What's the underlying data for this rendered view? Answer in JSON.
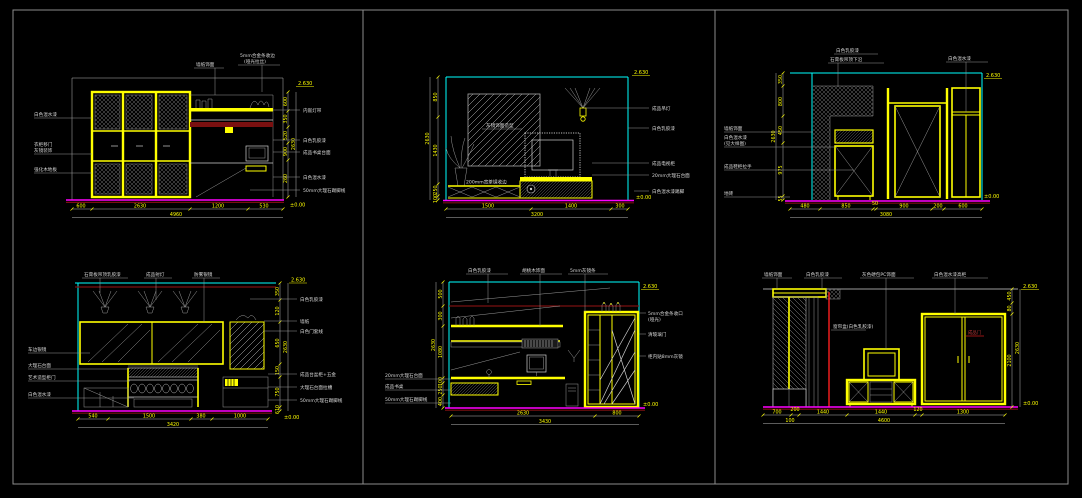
{
  "sheet": {
    "background": "#000000",
    "frame_color": "#8d8d8d",
    "grid": "3 columns x 2 rows of elevation drawings"
  },
  "colors": {
    "accent_yellow": "#ffff00",
    "accent_cyan": "#00ffff",
    "baseline_magenta": "#ff00ff",
    "dark_red": "#7a1010",
    "bright_red": "#ff2020",
    "line_gray": "#cfcfcf"
  },
  "panels": {
    "p1": {
      "top_labels": [
        "墙纸饰面",
        "5mm合金条收边",
        "(哑光拉丝)"
      ],
      "left_labels": [
        "白色混水漆",
        "衣柜移门",
        "灰镜装饰",
        "强化木地板"
      ],
      "right_labels": [
        "内嵌灯带",
        "白色乳胶漆",
        "成品书桌台面",
        "白色混水漆",
        "50mm大理石踢脚线"
      ],
      "dims_bottom": [
        "600",
        "2630",
        "1200",
        "530"
      ],
      "total_bottom": "4960",
      "dims_side": [
        "600",
        "350",
        "520",
        "900",
        "260"
      ],
      "total_side": "2630",
      "marker_top": "2.630",
      "marker_bottom": "±0.00"
    },
    "p2": {
      "mirror_label": "灰镜饰面造型",
      "stand_label": "200mm宽茶镜收边",
      "right_labels": [
        "成品吊灯",
        "白色乳胶漆",
        "成品电视柜",
        "20mm大理石台面",
        "白色混水漆踢脚"
      ],
      "dims_bottom": [
        "1500",
        "1400",
        "300"
      ],
      "total_bottom": "3200",
      "dims_side": [
        "850",
        "1430",
        "250",
        "100"
      ],
      "total_side": "2630",
      "marker_top": "2.630",
      "marker_bottom": "±0.00"
    },
    "p3": {
      "top_labels": [
        "白色乳胶漆",
        "石膏板吊顶下沿",
        "白色混水漆"
      ],
      "left_labels": [
        "墙纸饰面",
        "白色混水漆",
        "(见大样图)",
        "成品鞋柜拉手",
        "地砖"
      ],
      "dims_bottom": [
        "480",
        "850",
        "50",
        "900",
        "200",
        "600"
      ],
      "total_bottom": "3080",
      "dims_side": [
        "350",
        "800",
        "450",
        "975",
        "55"
      ],
      "total_side": "2630",
      "marker_top": "2.630",
      "marker_bottom": "±0.00"
    },
    "p4": {
      "top_labels": [
        "石膏板吊顶乳胶漆",
        "成品射灯",
        "防雾银镜"
      ],
      "left_labels": [
        "车边银镜",
        "大理石台面",
        "艺术造型柜门",
        "白色混水漆"
      ],
      "right_labels": [
        "白色乳胶漆",
        "墙纸",
        "白色门套线",
        "成品台盆柜+五金",
        "大理石台面拉槽",
        "50mm大理石踢脚线"
      ],
      "dims_bottom": [
        "540",
        "1500",
        "380",
        "1000"
      ],
      "total_bottom": "3420",
      "dims_side": [
        "350",
        "120",
        "650",
        "150",
        "750",
        "610"
      ],
      "total_side": "2630",
      "marker_top": "2.630",
      "marker_bottom": "±0.00"
    },
    "p5": {
      "top_labels": [
        "白色乳胶漆",
        "胡桃木饰面",
        "5mm灰镜条"
      ],
      "left_labels": [
        "20mm大理石台面",
        "成品书桌",
        "50mm大理石踢脚线"
      ],
      "right_labels": [
        "5mm合金条收口",
        "(哑光)",
        "清玻璃门",
        "柜内贴8mm灰镜"
      ],
      "dims_bottom": [
        "2630",
        "800"
      ],
      "total_bottom": "3430",
      "dims_side": [
        "500",
        "300",
        "1080",
        "100",
        "250",
        "400"
      ],
      "total_side": "2630",
      "marker_top": "2.630",
      "marker_bottom": "±0.00"
    },
    "p6": {
      "top_labels": [
        "墙纸饰面",
        "白色乳胶漆",
        "灰色硬包PC饰面",
        "白色混水漆高柜"
      ],
      "curtain_label": "窗帘盒(白色乳胶漆)",
      "door_label": "成品门",
      "dims_bottom": [
        "700",
        "200",
        "1440",
        "1440",
        "120",
        "1300"
      ],
      "sub_dim": "100",
      "total_bottom": "4600",
      "dims_side": [
        "450",
        "80",
        "2100"
      ],
      "total_side": "2630",
      "marker_top": "2.630",
      "marker_bottom": "±0.00"
    }
  }
}
